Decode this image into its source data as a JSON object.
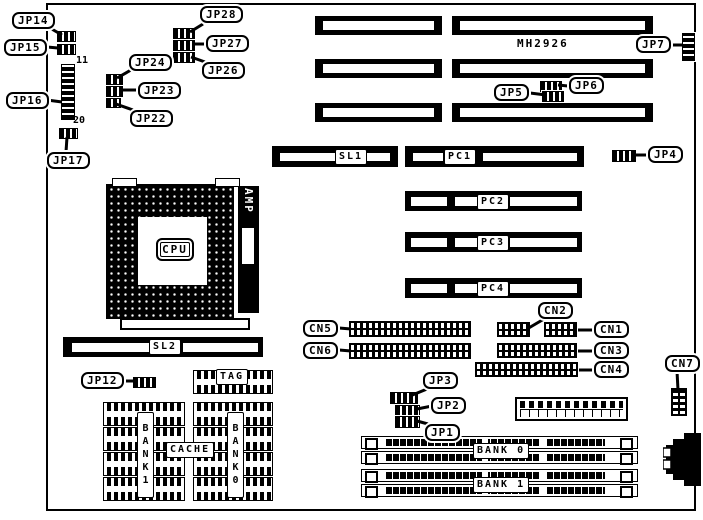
{
  "board": {
    "chipset_text": "MH2926",
    "cpu_label": "CPU",
    "amp_label": "AMP",
    "pin_top": "11",
    "pin_bottom": "20"
  },
  "jumpers": {
    "jp1": "JP1",
    "jp2": "JP2",
    "jp3": "JP3",
    "jp4": "JP4",
    "jp5": "JP5",
    "jp6": "JP6",
    "jp7": "JP7",
    "jp12": "JP12",
    "jp14": "JP14",
    "jp15": "JP15",
    "jp16": "JP16",
    "jp17": "JP17",
    "jp22": "JP22",
    "jp23": "JP23",
    "jp24": "JP24",
    "jp26": "JP26",
    "jp27": "JP27",
    "jp28": "JP28"
  },
  "connectors": {
    "cn1": "CN1",
    "cn2": "CN2",
    "cn3": "CN3",
    "cn4": "CN4",
    "cn5": "CN5",
    "cn6": "CN6",
    "cn7": "CN7"
  },
  "slots": {
    "sl1": "SL1",
    "sl2": "SL2",
    "pc1": "PC1",
    "pc2": "PC2",
    "pc3": "PC3",
    "pc4": "PC4"
  },
  "memory": {
    "bank0": "BANK 0",
    "bank1": "BANK 1"
  },
  "cache": {
    "tag": "TAG",
    "cache": "CACHE",
    "bank0_col": "BANK0",
    "bank1_col": "BANK1"
  },
  "colors": {
    "ink": "#000000",
    "paper": "#ffffff"
  }
}
